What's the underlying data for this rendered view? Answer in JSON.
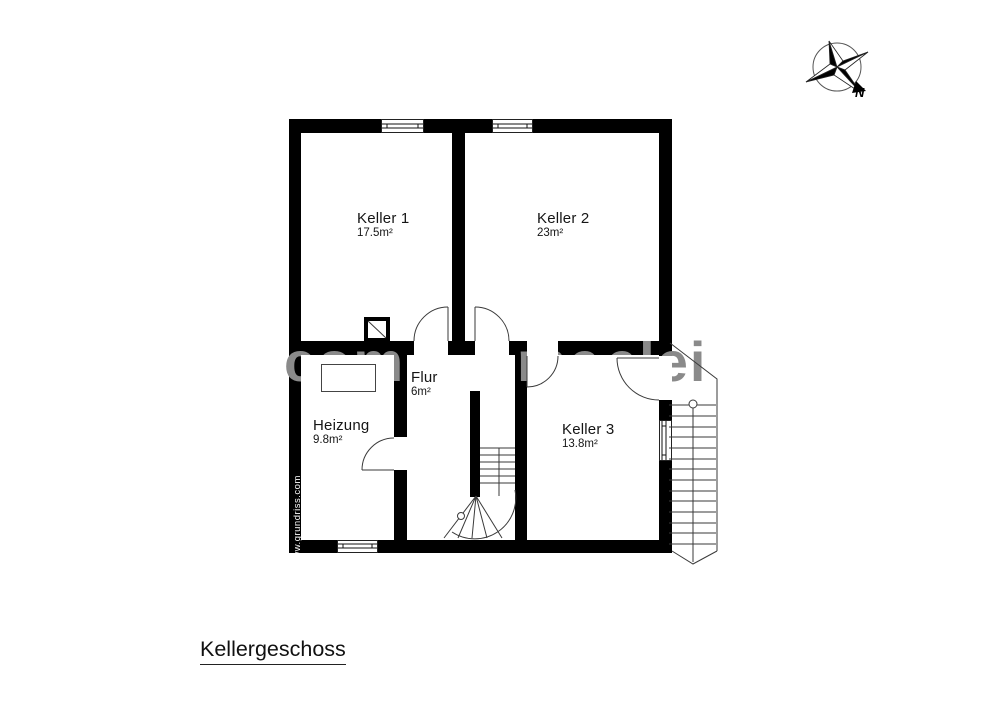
{
  "plan": {
    "floor_title": "Kellergeschoss",
    "rooms": [
      {
        "name": "Keller 1",
        "area": "17.5m²"
      },
      {
        "name": "Keller 2",
        "area": "23m²"
      },
      {
        "name": "Heizung",
        "area": "9.8m²"
      },
      {
        "name": "Flur",
        "area": "6m²"
      },
      {
        "name": "Keller 3",
        "area": "13.8m²"
      }
    ]
  },
  "compass": {
    "north_label": "N"
  },
  "watermarks": {
    "site": "www.grundriss.com",
    "fragments": [
      {
        "text": "com"
      },
      {
        "text": "me"
      },
      {
        "text": "elei"
      }
    ]
  },
  "colors": {
    "wall": "#000000",
    "line": "#3a3a3a",
    "watermark_gray": "#8a8a8a",
    "text": "#111111"
  }
}
